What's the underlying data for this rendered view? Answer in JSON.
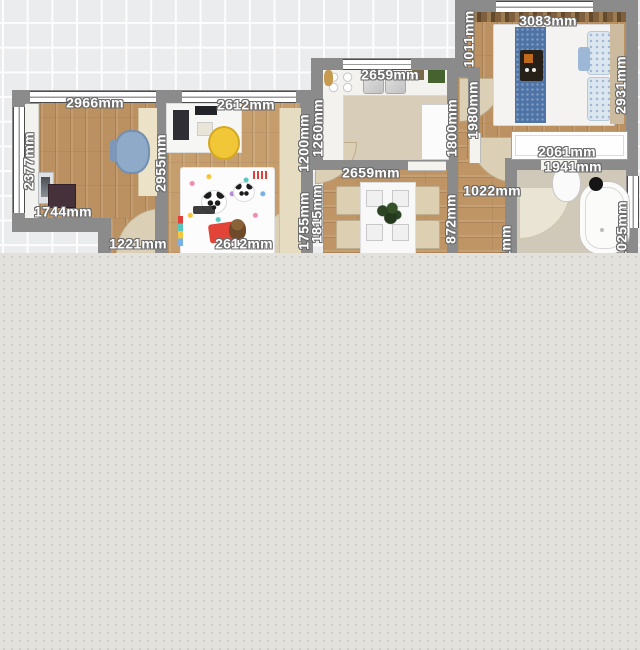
{
  "canvas": {
    "grid_color": "#ebecee",
    "workspace_color": "#e3e1dc",
    "wall_color": "#8b8b8b",
    "wood_floor_color": "#bc9161",
    "tile_floor_color": "#d7cdb8",
    "label_text_color": "#ffffff",
    "label_outline_color": "#6b6b6b"
  },
  "rooms": {
    "office": "office-room",
    "kids": "kids-room",
    "kitchen": "kitchen",
    "dining": "dining-room",
    "bedroom": "bedroom",
    "bathroom": "bathroom",
    "hallway": "hallway",
    "closet": "closet"
  },
  "dims": {
    "r1_top": "2966mm",
    "r1_left": "2377mm",
    "r1_bottom_left": "1744mm",
    "r1_right": "2955mm",
    "r1_bottom": "1221mm",
    "r2_top": "2612mm",
    "r2_bottom": "2612mm",
    "r2_right_upper": "1200mm",
    "r2_right_lower": "1755mm",
    "kitchen_top": "2659mm",
    "kitchen_left": "1260mm",
    "kitchen_right": "1800mm",
    "dining_top": "2659mm",
    "dining_left": "1815mm",
    "dining_right": "872mm",
    "bedroom_top": "3083mm",
    "bedroom_left_upper": "1011mm",
    "bedroom_left_lower": "1980mm",
    "bedroom_right": "2931mm",
    "closet_width": "2061mm",
    "bathroom_top": "1941mm",
    "hallway_width": "1022mm",
    "hallway_left": "861mm",
    "bathroom_right": "1025mm"
  },
  "furniture_colors": {
    "office_chair_blue": "#8fa9c9",
    "kids_chair_yellow": "#f1c637",
    "bed_runner_blue": "#4e73a6",
    "kids_pillow_red": "#e24438",
    "teddy_brown": "#7a5431",
    "plant_green": "#2c4423"
  }
}
